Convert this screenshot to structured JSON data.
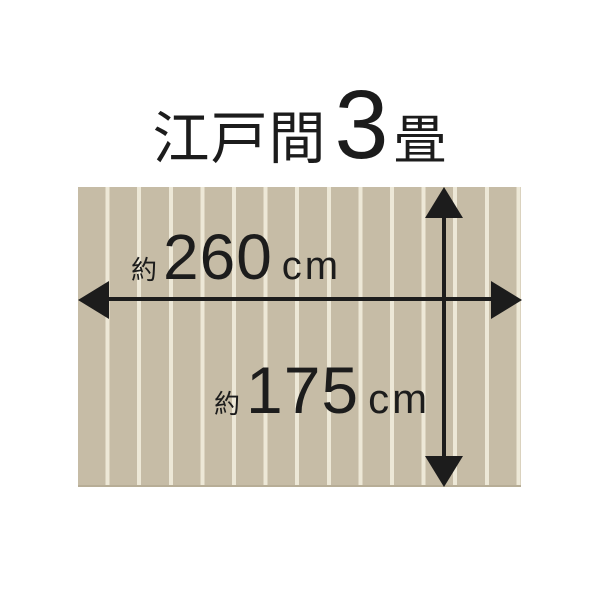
{
  "title": {
    "size_name": "江戸間",
    "mat_count": "3",
    "mat_unit": "畳"
  },
  "dimensions": {
    "width": {
      "approx_prefix": "約",
      "value": "260",
      "unit": "cm"
    },
    "height": {
      "approx_prefix": "約",
      "value": "175",
      "unit": "cm"
    }
  },
  "icons": {
    "width_arrow": "double-headed-arrow-horizontal",
    "height_arrow": "double-headed-arrow-vertical"
  },
  "colors": {
    "bg": "#ffffff",
    "ink": "#1c1c1c",
    "floor_base": "#c6bca6",
    "floor_stripe": "#ede8d7",
    "floor_edge": "#b7ad96"
  }
}
